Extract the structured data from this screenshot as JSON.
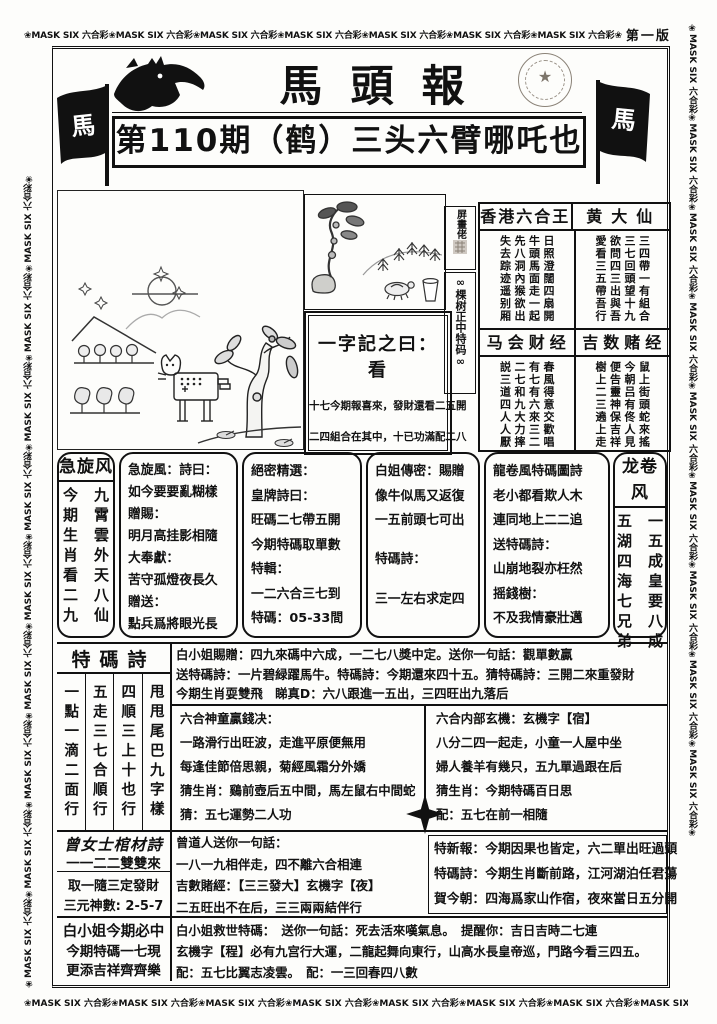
{
  "page": {
    "edition": "第一版"
  },
  "border": {
    "top_text": "❀MASK SIX 六合彩❀MASK SIX 六合彩❀MASK SIX 六合彩❀MASK SIX 六合彩❀MASK SIX 六合彩❀MASK SIX 六合彩❀MASK SIX 六合彩❀",
    "top_tail": "❀MASK SIX",
    "left_text": "❀MASK SIX 六合彩❀MASK SIX 六合彩❀MASK SIX 六合彩❀MASK SIX 六合彩❀MASK SIX 六合彩❀MASK SIX 六合彩❀MASK SIX 六合彩❀MASK SIX 六合彩❀MASK SIX 六合彩❀",
    "right_text": "❀MASK SIX 六合彩❀MASK SIX 六合彩❀MASK SIX 六合彩❀MASK SIX 六合彩❀MASK SIX 六合彩❀MASK SIX 六合彩❀MASK SIX 六合彩❀MASK SIX 六合彩❀MASK SIX 六合彩❀",
    "bottom_text": "❀MASK SIX 六合彩❀MASK SIX 六合彩❀MASK SIX 六合彩❀MASK SIX 六合彩❀MASK SIX 六合彩❀MASK SIX 六合彩❀MASK SIX 六合彩❀MASK SIX 六合彩❀MASK SIX"
  },
  "masthead": {
    "title": "馬頭報",
    "headline": "第110期（鹤）三头六臂哪吒也",
    "flag_glyph": "馬",
    "seal_star": "★"
  },
  "right_panel": {
    "side_top": "屏畫佬",
    "side_bottom": "∞棵树正中特码∞",
    "sections": [
      {
        "title": "香港六合王",
        "lines": [
          "日照澄闊四扇開",
          "牛頭馬面走一起",
          "先八洞內猴欲出",
          "失去踪迹遥别厢"
        ]
      },
      {
        "title": "黄大仙",
        "lines": [
          "三四帶一有組合",
          "三七回頭望十九",
          "欲問四三出與吾",
          "愛看三五帶吾行"
        ]
      },
      {
        "title": "马会财经",
        "lines": [
          "春風得意交歡唱",
          "有七有六來三二",
          "二七和九大力摔",
          "説三道四人人厭"
        ]
      },
      {
        "title": "吉数赌经",
        "lines": [
          "鼠上街頭蛇來搖",
          "今朝吕有佟人見",
          "便告靈神保吉祥",
          "樹上二三遶上走"
        ]
      }
    ]
  },
  "zi_box": {
    "title": "一字記之曰：看",
    "line1": "十七今期報喜來，發財還看二五開",
    "line2": "二四組合在其中，十已功滿配二八"
  },
  "xuanfeng": {
    "title": "急旋风",
    "right_line": "今期生肖看二九",
    "left_line": "九霄雲外天八仙"
  },
  "xuanfeng_poem": {
    "lines": [
      "急旋風：詩曰：",
      "如今要要亂糊樣",
      "贈賜：",
      "明月高挂影相隨",
      "大奉獻：",
      "苦守孤燈夜長久",
      "贈送：",
      "點兵爲將眼光長"
    ]
  },
  "juemi": {
    "lines": [
      "絕密精選：",
      "皇牌詩曰：",
      "旺碼二七帶五開",
      "今期特碼取單數",
      "特輯：",
      "一二六合三七到",
      "特碼：05-33間"
    ]
  },
  "baijie": {
    "lines": [
      "白姐傳密：賜贈",
      "像牛似馬又返復",
      "一五前頭七可出",
      "特碼詩：",
      "三一左右求定四"
    ]
  },
  "longjuan_poem": {
    "lines": [
      "龍卷風特碼圖詩",
      "老小都看欺人木",
      "連同地上二二追",
      "送特碼詩：",
      "山崩地裂亦枉然",
      "摇錢樹：",
      "不及我情豪壯邁"
    ]
  },
  "longjuan": {
    "title": "龙卷风",
    "right_line": "五湖四海七兄弟",
    "left_line": "一五成皇要八成"
  },
  "tema": {
    "title": "特碼詩",
    "cols": [
      "甩甩尾巴九字樣",
      "四順三上十也行",
      "五走三七合順行",
      "一點一滴二面行"
    ]
  },
  "tips": {
    "rows": [
      "白小姐賜贈：四九來碼中六成，一二七八獎中定。送你一句話：觀單數贏",
      "送特碼詩：一片碧緑躍馬牛。特碼詩：今期還來四十五。猜特碼詩：三開二來重發財",
      "今期生肖耍雙飛　睇真D：六八跟進一五出，三四旺出九落后"
    ]
  },
  "shentong": {
    "lines": [
      "六合神童贏錢决：",
      "一路滑行出旺波，走進平原便無用",
      "每逢佳節倍思親，菊經風霜分外嬌",
      "猜生肖：鷄前壺后五中間，馬左鼠右中間蛇",
      "猜：五七運勢二人功"
    ]
  },
  "neibu": {
    "lines": [
      "六合内部玄機：玄機字【宿】",
      "八分二四一起走，小童一人屋中坐",
      "婦人養羊有幾只，五九單過跟在后",
      "猜生肖：今期特碼百日思",
      "配：五七在前一相隨"
    ]
  },
  "coffin": {
    "title": "曾女士棺材詩",
    "line1": "一一二二雙雙來",
    "line2": "取一隨三定發財",
    "line3": "三元神數: 2-5-7"
  },
  "zengdao": {
    "lines": [
      "曾道人送你一句話：",
      "一八一九相伴走，四不離六合相連",
      "吉數賭經：【三三發大】玄機字【夜】",
      "二五旺出不在后，三三兩兩結伴行"
    ]
  },
  "texin": {
    "lines": [
      "特新報：今期因果也皆定，六二單出旺過頭",
      "特碼詩：今期生肖斷前路，江河湖泊任君蕩",
      "賀今朝：四海爲家山作宿，夜來當日五分開"
    ]
  },
  "must": {
    "title": "白小姐今期必中",
    "line1": "今期特碼一七現",
    "line2": "更添吉祥齊齊樂"
  },
  "jiushi": {
    "lines": [
      "白小姐救世特碼：　送你一句話：死去活來嘆氣息。　提醒你：吉日吉時二七連",
      "玄機字【程】必有九宫行大運，二龍起舞向東行，山高水長皇帝巡，門路今看三四五。",
      "配：五七比翼志凌雲。　配：一三回春四八數"
    ]
  }
}
